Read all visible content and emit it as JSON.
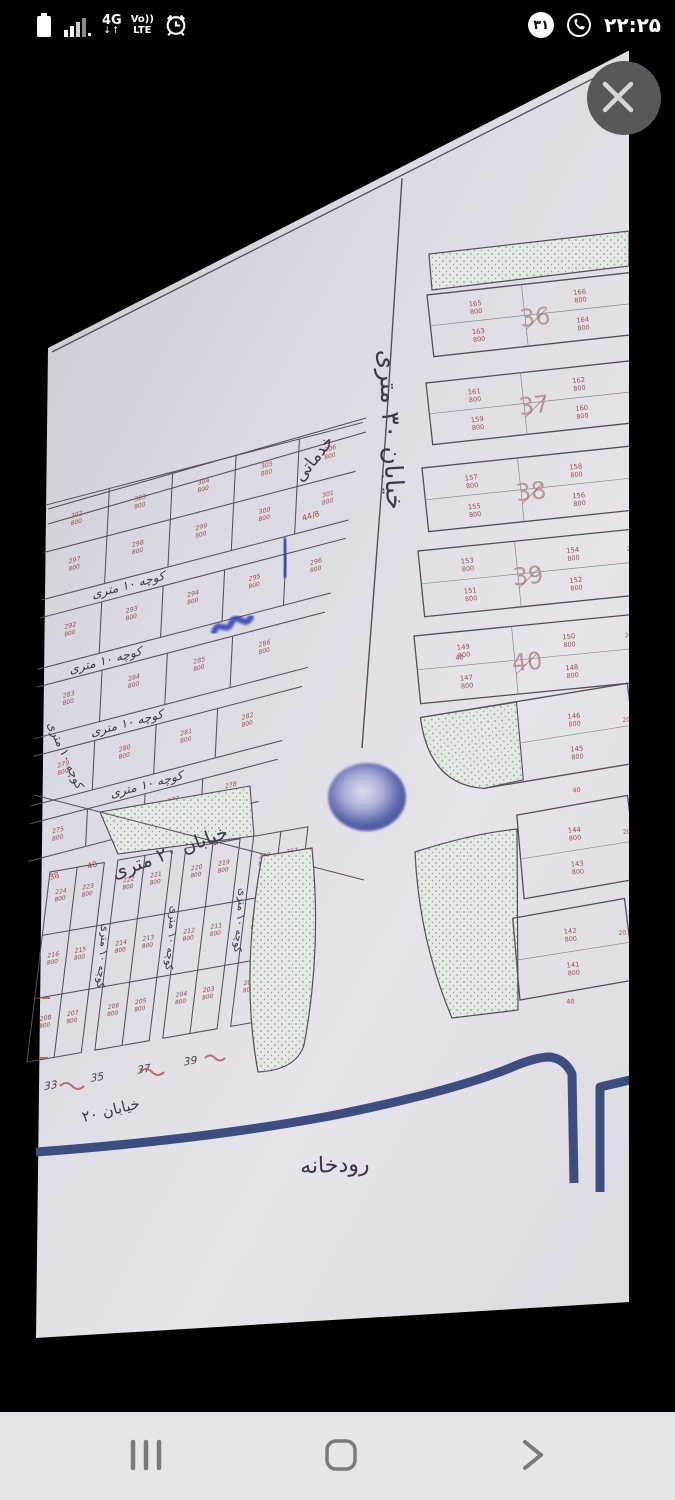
{
  "status_bar": {
    "time": "۲۲:۲۵",
    "whatsapp_badge": "۳۱",
    "network_4g": "4G",
    "network_arrows": "↓↑",
    "volte": "Vo))",
    "lte": "LTE"
  },
  "map": {
    "labels": {
      "street_30": "خیابان ۳۰ متری",
      "street_20": "خیابان ۲۰ متری",
      "street_20_short": "خیابان ۲۰",
      "alley_10": "کوچه ۱۰ متری",
      "services": "خدماتی",
      "river": "رودخانه"
    },
    "denominator": "800",
    "right_blocks": [
      {
        "label": "36",
        "cells": [
          "165",
          "166",
          "163",
          "164"
        ]
      },
      {
        "label": "37",
        "cells": [
          "161",
          "162",
          "159",
          "160"
        ]
      },
      {
        "label": "38",
        "cells": [
          "157",
          "158",
          "155",
          "156"
        ]
      },
      {
        "label": "39",
        "cells": [
          "153",
          "154",
          "151",
          "152"
        ]
      },
      {
        "label": "40",
        "cells": [
          "149",
          "150",
          "147",
          "148"
        ]
      }
    ],
    "right_strips": [
      {
        "cells": [
          "146",
          "145"
        ]
      },
      {
        "cells": [
          "144",
          "143"
        ]
      },
      {
        "cells": [
          "142",
          "141"
        ]
      }
    ],
    "upper_left_rows": {
      "a1": [
        "302",
        "303",
        "304",
        "305",
        "306"
      ],
      "a2": [
        "297",
        "298",
        "299",
        "300",
        "301"
      ],
      "b1": [
        "292",
        "293",
        "294",
        "295",
        "296"
      ],
      "c1": [
        "283",
        "284",
        "285",
        "286"
      ],
      "c2": [
        "279",
        "280",
        "281",
        "282"
      ],
      "d1": [
        "275",
        "276",
        "277",
        "278"
      ]
    },
    "bottom_grid": {
      "r1": [
        "224",
        "223",
        "222",
        "221",
        "220",
        "219",
        "218",
        "217"
      ],
      "r2": [
        "216",
        "215",
        "214",
        "213",
        "212",
        "211",
        "210",
        "209"
      ],
      "r3": [
        "208",
        "207",
        "206",
        "205",
        "204",
        "203",
        "202",
        "201"
      ],
      "street_numbers": [
        "33",
        "35",
        "37",
        "39"
      ]
    },
    "red_marks": {
      "forty": "40",
      "thirty_eight": "38",
      "edge": "20",
      "corner": "44/8"
    }
  }
}
